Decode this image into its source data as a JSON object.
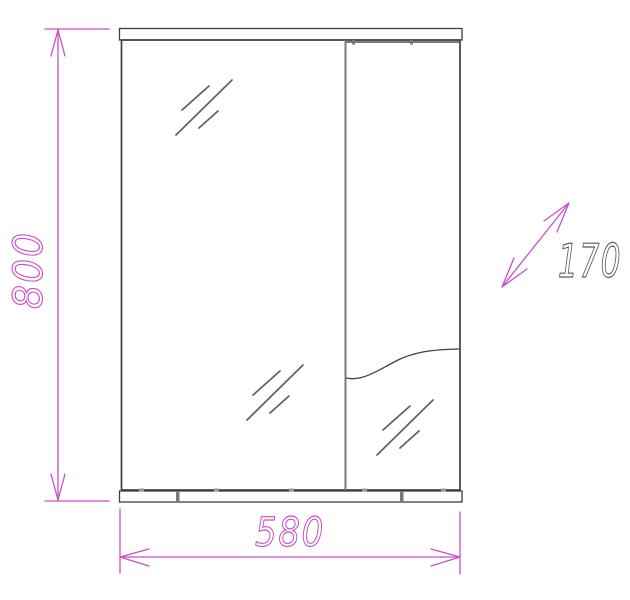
{
  "drawing": {
    "kind": "mirror-cabinet-front-elevation",
    "dimensions": {
      "height_mm": "800",
      "width_mm": "580",
      "depth_mm": "170"
    },
    "colors": {
      "background": "#ffffff",
      "dimension_line": "#c94fc9",
      "outline": "#3f3f3f",
      "panel_edge": "#7a7a7a",
      "hatch": "#5f5f5f",
      "depth_label": "#595959"
    },
    "icons": {
      "glass_hatch": "diagonal-slash-glass-mark",
      "arrow_style": "open-v-cad-arrow"
    }
  }
}
